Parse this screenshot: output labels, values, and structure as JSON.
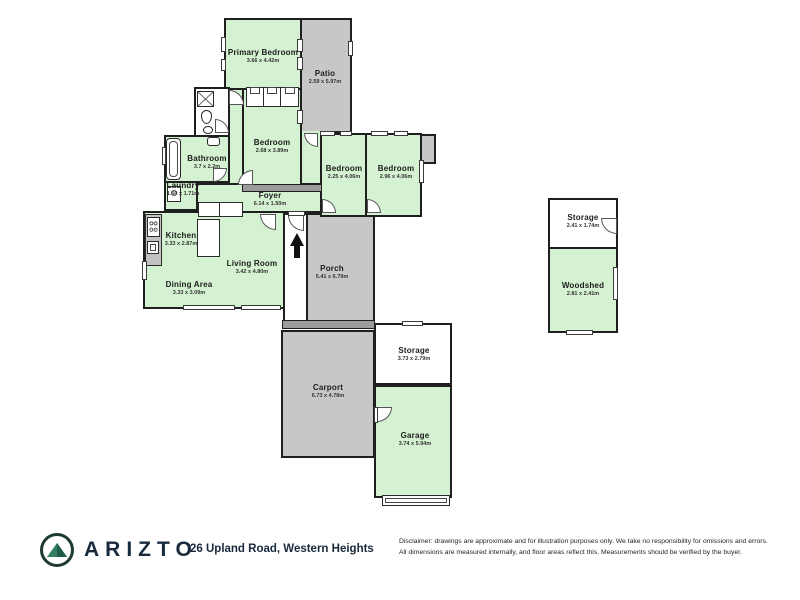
{
  "colors": {
    "room_fill": "#d4f1d1",
    "outdoor_fill": "#c7c7c7",
    "wall": "#1f1f1f",
    "brand_navy": "#182a3c",
    "logo_green": "#2f8161"
  },
  "icons": {
    "entry_arrow": "arrow-up",
    "logo": "mountain-in-circle"
  },
  "rooms": {
    "primary_bedroom": {
      "name": "Primary Bedroom",
      "dims": "3.66 x 4.42m"
    },
    "patio": {
      "name": "Patio",
      "dims": "2.59 x 5.97m"
    },
    "bedroom_2": {
      "name": "Bedroom",
      "dims": "2.68 x 3.89m"
    },
    "bedroom_3": {
      "name": "Bedroom",
      "dims": "2.25 x 4.06m"
    },
    "bedroom_4": {
      "name": "Bedroom",
      "dims": "2.96 x 4.06m"
    },
    "bathroom": {
      "name": "Bathroom",
      "dims": "3.7 x 2.2m"
    },
    "laundry": {
      "name": "Laundry",
      "dims": "1.50 x 1.71m"
    },
    "foyer": {
      "name": "Foyer",
      "dims": "6.14 x 1.50m"
    },
    "kitchen": {
      "name": "Kitchen",
      "dims": "3.33 x 2.87m"
    },
    "living_room": {
      "name": "Living Room",
      "dims": "3.42 x 4.80m"
    },
    "dining_area": {
      "name": "Dining Area",
      "dims": "3.33 x 3.09m"
    },
    "porch": {
      "name": "Porch",
      "dims": "5.41 x 6.79m"
    },
    "carport": {
      "name": "Carport",
      "dims": "6.73 x 4.78m"
    },
    "storage_main": {
      "name": "Storage",
      "dims": "3.73 x 2.79m"
    },
    "garage": {
      "name": "Garage",
      "dims": "3.74 x 5.94m"
    },
    "storage_outbuilding": {
      "name": "Storage",
      "dims": "2.41 x 1.74m"
    },
    "woodshed": {
      "name": "Woodshed",
      "dims": "2.81 x 2.41m"
    }
  },
  "footer": {
    "brand": "ARIZTO",
    "address": "26 Upland Road, Western Heights",
    "disclaimer_line1": "Disclaimer: drawings are approximate and for illustration purposes only. We take no responsibility for omissions and errors.",
    "disclaimer_line2": "All dimensions are measured internally, and floor areas reflect this. Measurements should be verified by the buyer."
  }
}
